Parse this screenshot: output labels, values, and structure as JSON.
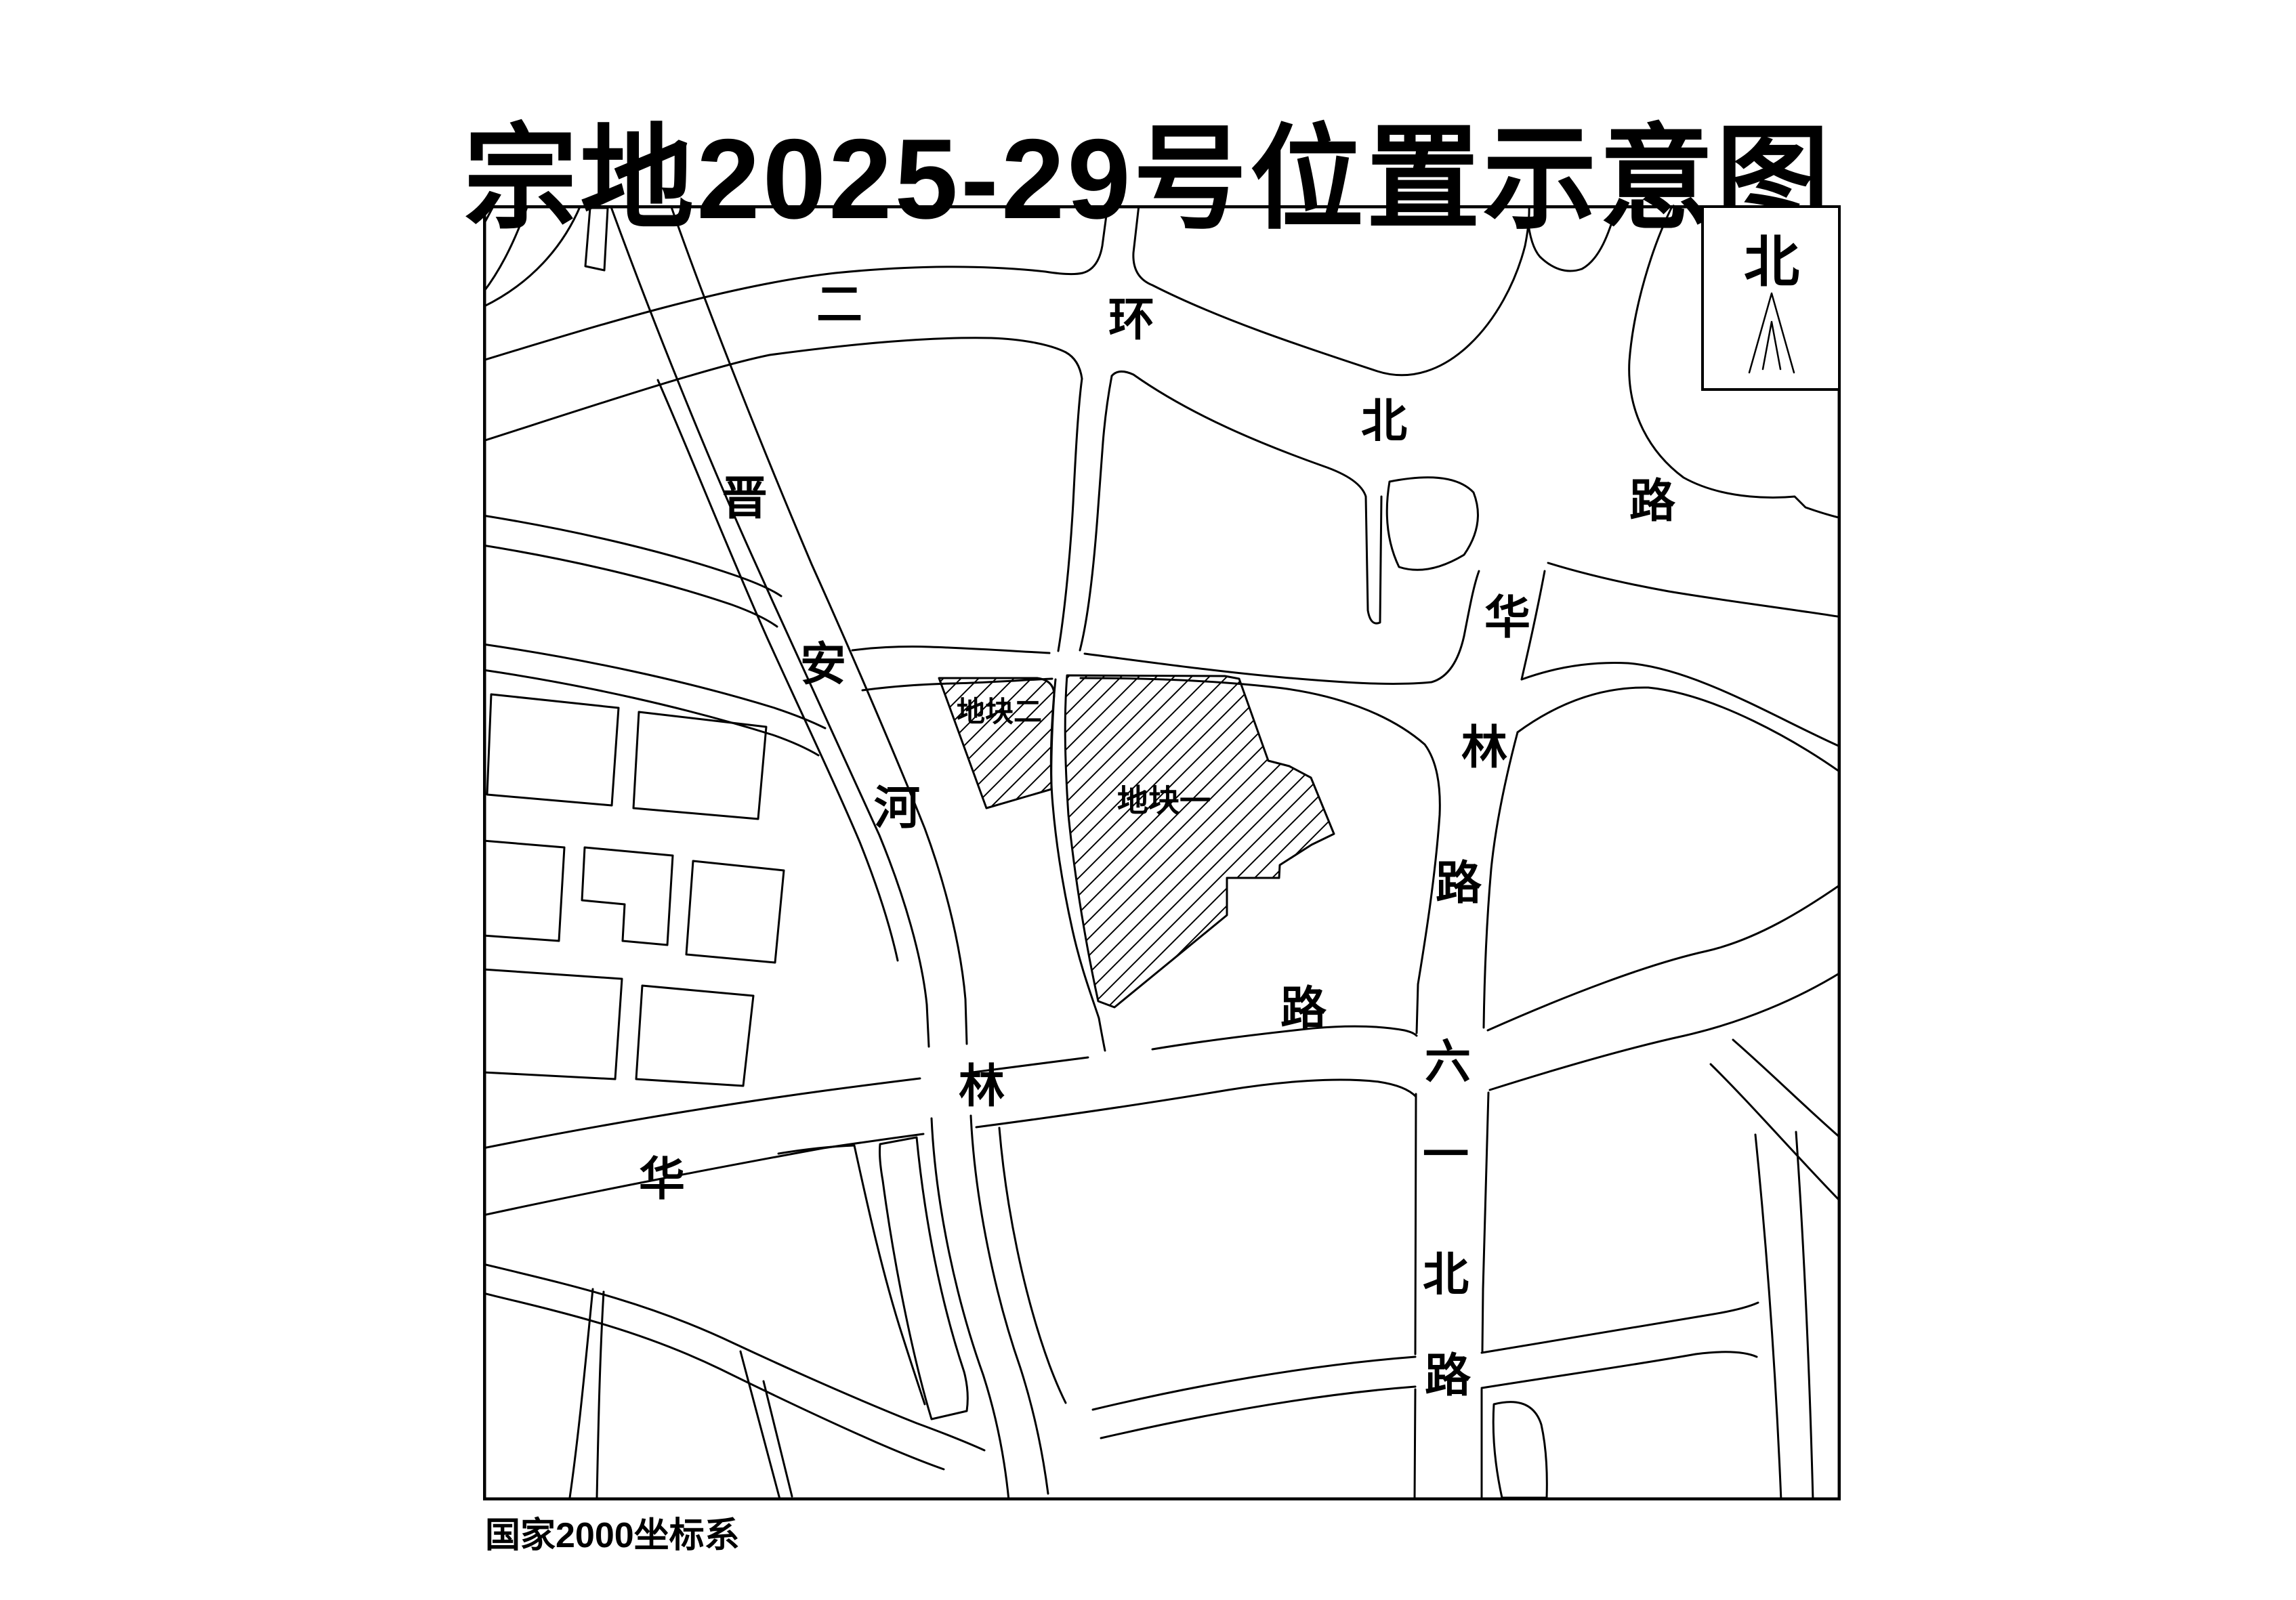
{
  "page": {
    "background": "#ffffff",
    "line_color": "#000000"
  },
  "title": "宗地2025-29号位置示意图",
  "footer": {
    "coordinate_system": "国家2000坐标系"
  },
  "north_box": {
    "label": "北"
  },
  "parcels": [
    {
      "id": "parcel-1",
      "label": "地块一"
    },
    {
      "id": "parcel-2",
      "label": "地块二"
    }
  ],
  "roads": {
    "erhuan_bei_lu": {
      "name": "二环北路",
      "chars": [
        "二",
        "环",
        "北",
        "路"
      ]
    },
    "jinan_he": {
      "name": "晋安河",
      "chars": [
        "晋",
        "安",
        "河"
      ]
    },
    "hualin_lu_vertical": {
      "name": "华林路",
      "chars": [
        "华",
        "林",
        "路"
      ]
    },
    "hualin_lu_diagonal": {
      "name": "华林路",
      "chars": [
        "华",
        "林",
        "路"
      ]
    },
    "liuyi_bei_lu": {
      "name": "六一北路",
      "chars": [
        "六",
        "一",
        "北",
        "路"
      ]
    }
  }
}
